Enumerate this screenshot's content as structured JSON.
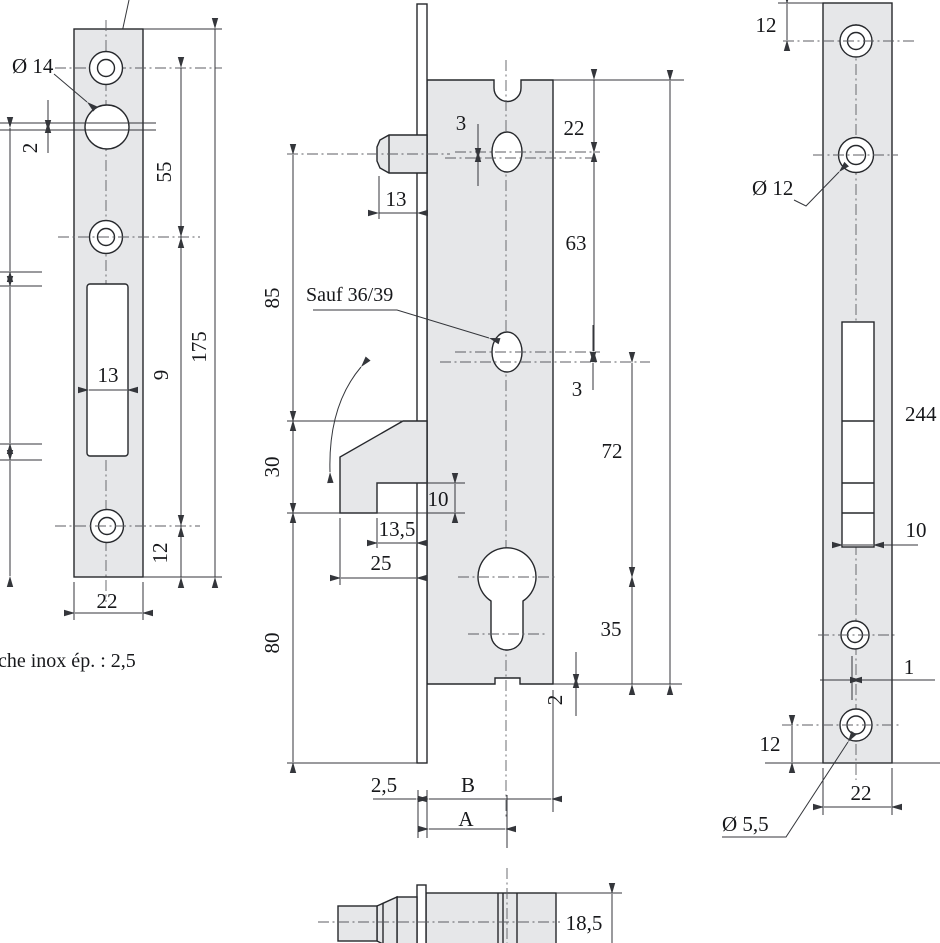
{
  "left_view": {
    "dia14": "Ø 14",
    "gap": "2",
    "d55": "55",
    "d9": "9",
    "d175": "175",
    "slot_w": "13",
    "d12": "12",
    "width": "22",
    "p1": "51",
    "p2": "50",
    "p3": "38",
    "caption": "che inox ép. : 2,5"
  },
  "middle_view": {
    "bolt_len": "13",
    "offset_top": "3",
    "d22": "22",
    "d63": "63",
    "note": "Sauf 36/39",
    "offset_mid": "3",
    "d85": "85",
    "d30": "30",
    "d80": "80",
    "hook_gap": "10",
    "d135": "13,5",
    "d25": "25",
    "d72": "72",
    "d35": "35",
    "tab": "2",
    "faceplate_th": "2,5",
    "dimB": "B",
    "dimA": "A",
    "half_w": "18,5"
  },
  "right_view": {
    "d12_top": "12",
    "dia12": "Ø 12",
    "height": "244",
    "slot_w": "10",
    "offset": "1",
    "d12_bot": "12",
    "width": "22",
    "dia55": "Ø 5,5"
  }
}
